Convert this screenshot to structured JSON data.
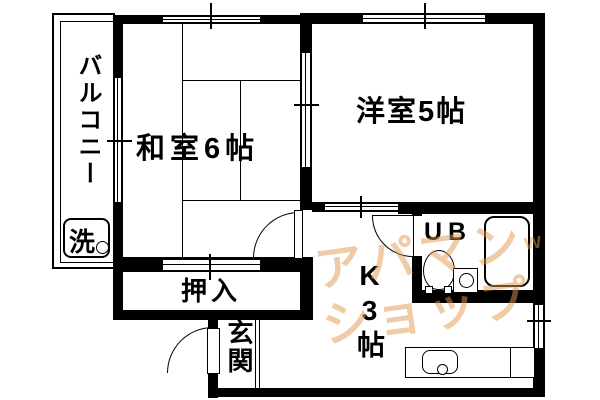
{
  "title": "2K apartment floor plan",
  "rooms": {
    "washitsu": {
      "label": "和室6帖"
    },
    "youshitsu": {
      "label": "洋室5帖"
    },
    "kitchen": {
      "label": "K3帖"
    },
    "oshiire": {
      "label": "押入"
    },
    "genkan": {
      "label": "玄関"
    },
    "balcony": {
      "label": "バルコニー"
    },
    "unit_bath": {
      "label": "UB"
    },
    "washer": {
      "label": "洗"
    }
  },
  "watermark": {
    "line1": "アパマン",
    "mark": "w",
    "line2": "ショップ",
    "color": "#e09a50"
  },
  "colors": {
    "line": "#000000",
    "background": "#ffffff"
  }
}
